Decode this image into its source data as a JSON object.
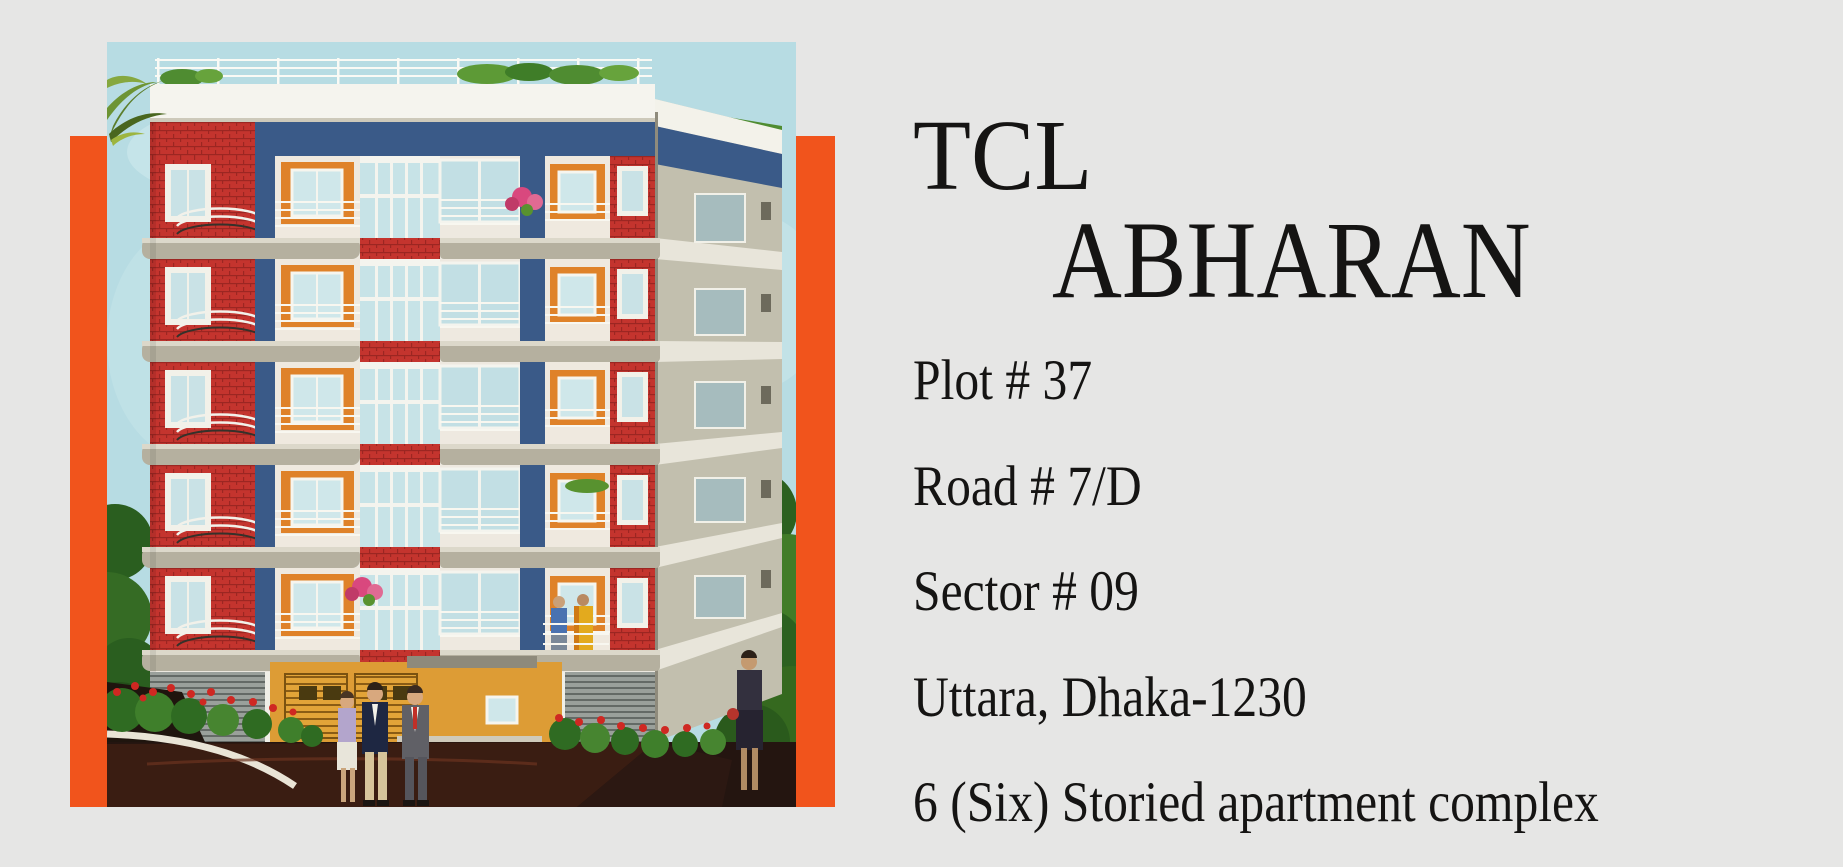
{
  "page": {
    "width_px": 1843,
    "height_px": 867,
    "background_color": "#e6e6e5",
    "text_color": "#151413"
  },
  "hero": {
    "accent_color": "#f1541c",
    "illustration": {
      "alt": "Architectural rendering of a six-storied apartment building with red brick and blue facade, white curved balconies, orange window panels, rooftop plants, landscaped entrance with shrubs and people walking in front",
      "sky_color": "#b7dce3",
      "brick_red": "#c4342e",
      "facade_blue": "#3a5a88",
      "window_orange": "#df8229",
      "foliage_green": "#3f7d28",
      "driveway_maroon": "#3a1d12"
    }
  },
  "heading": {
    "line1": "TCL",
    "line2": "ABHARAN"
  },
  "address": {
    "lines": [
      "Plot # 37",
      "Road # 7/D",
      "Sector # 09",
      "Uttara, Dhaka-1230",
      "6 (Six) Storied apartment complex"
    ]
  }
}
